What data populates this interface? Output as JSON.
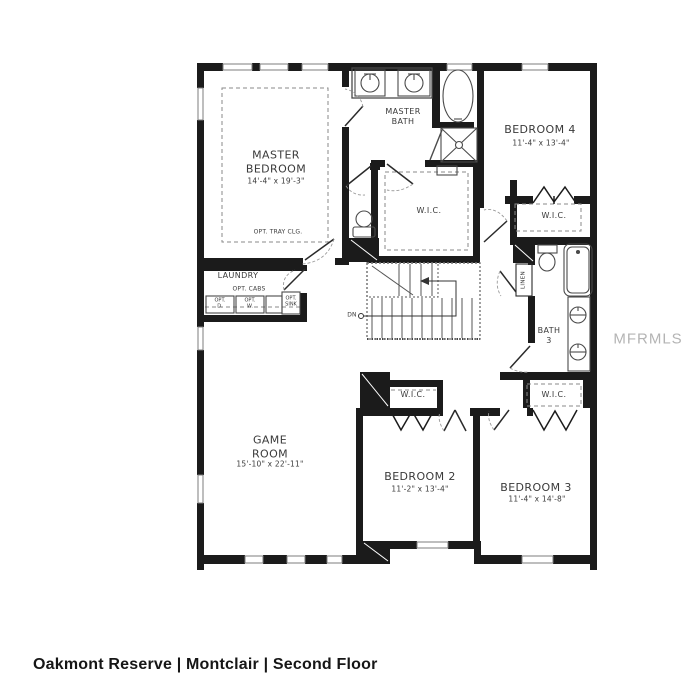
{
  "caption": "Oakmont Reserve | Montclair | Second Floor",
  "watermark": "MFRMLS",
  "rooms": {
    "master_bedroom": {
      "name": "MASTER\nBEDROOM",
      "dims": "14'-4\" x 19'-3\"",
      "note": "OPT. TRAY CLG."
    },
    "master_bath": {
      "name": "MASTER\nBATH"
    },
    "master_wic": {
      "name": "W.I.C."
    },
    "bedroom4": {
      "name": "BEDROOM 4",
      "dims": "11'-4\" x 13'-4\""
    },
    "bedroom4_wic": {
      "name": "W.I.C."
    },
    "bath3": {
      "name": "BATH\n3"
    },
    "linen": {
      "name": "LINEN"
    },
    "laundry": {
      "name": "LAUNDRY",
      "cabs_note": "OPT. CABS",
      "dryer": "OPT.\nD.",
      "washer": "OPT.\nW.",
      "sink": "OPT.\nSINK"
    },
    "stairs": {
      "down_label": "DN"
    },
    "game_room": {
      "name": "GAME\nROOM",
      "dims": "15'-10\" x 22'-11\""
    },
    "bedroom2": {
      "name": "BEDROOM 2",
      "dims": "11'-2\" x 13'-4\""
    },
    "bedroom2_wic": {
      "name": "W.I.C."
    },
    "bedroom3": {
      "name": "BEDROOM 3",
      "dims": "11'-4\" x 14'-8\""
    },
    "bedroom3_wic": {
      "name": "W.I.C."
    }
  }
}
